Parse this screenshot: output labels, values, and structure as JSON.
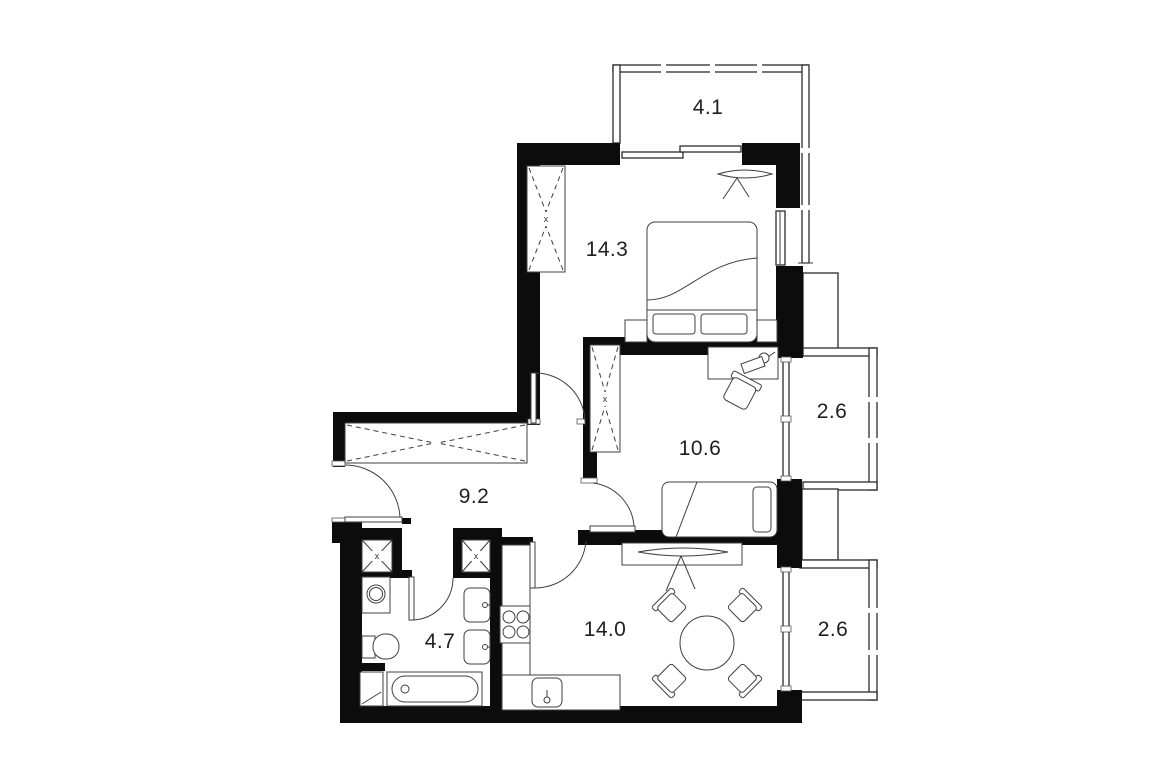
{
  "plan": {
    "type": "apartment-floor-plan",
    "units": "m2",
    "rooms": [
      {
        "id": "balcony-top",
        "area": "4.1"
      },
      {
        "id": "bedroom",
        "area": "14.3"
      },
      {
        "id": "bedroom-small",
        "area": "10.6"
      },
      {
        "id": "hallway",
        "area": "9.2"
      },
      {
        "id": "bathroom",
        "area": "4.7"
      },
      {
        "id": "kitchen-living",
        "area": "14.0"
      },
      {
        "id": "balcony-right-upper",
        "area": "2.6"
      },
      {
        "id": "balcony-right-lower",
        "area": "2.6"
      }
    ],
    "symbols": {
      "wardrobe_marker": "x",
      "shaft_marker": "x"
    },
    "colors": {
      "wall": "#0c0c0c",
      "line": "#3f3f3f",
      "background": "#ffffff",
      "text": "#1f1f1f"
    }
  }
}
